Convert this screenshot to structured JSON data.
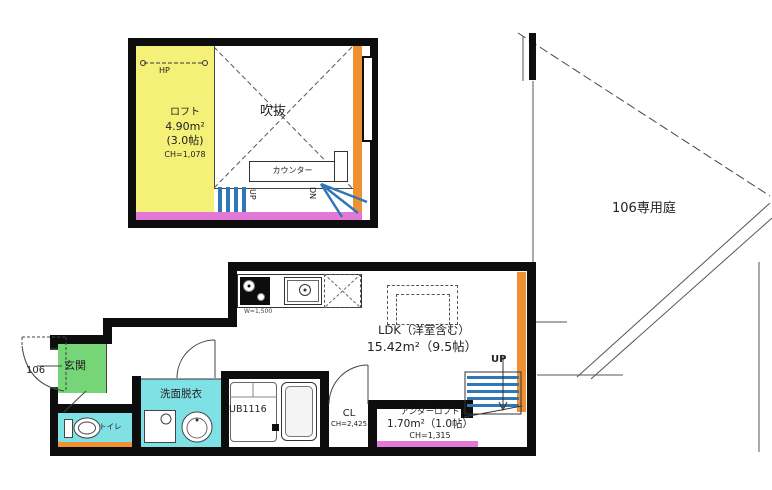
{
  "loft": {
    "name": "ロフト",
    "area": "4.90m²",
    "tatami": "(3.0帖)",
    "ceiling": "CH=1,078",
    "hanger_pipe": "HP",
    "void_label": "吹抜",
    "counter": "カウンター",
    "up": "UP",
    "down": "DN"
  },
  "garden": {
    "label": "106専用庭"
  },
  "main": {
    "ldk_label": "LDK（洋室含む）",
    "ldk_area": "15.42m²（9.5帖）",
    "kitchen_width": "W=1,500",
    "entrance": "玄関",
    "unit_number": "106",
    "toilet": "トイレ",
    "washroom": "洗面脱衣",
    "bath": "UB1116",
    "closet": "CL",
    "closet_ceiling": "CH=2,425",
    "under_loft_name": "アンダーロフト",
    "under_loft_area": "1.70m²（1.0帖）",
    "under_loft_ceiling": "CH=1,315",
    "stairs_up": "UP"
  },
  "colors": {
    "wall": "#0d0d0d",
    "loft_yellow": "#f5f078",
    "loft_edge_magenta": "#e379d6",
    "window_orange": "#ee9133",
    "wet_area_cyan": "#7fe1e4",
    "entrance_green": "#76d677",
    "stair_blue": "#3077b8"
  }
}
